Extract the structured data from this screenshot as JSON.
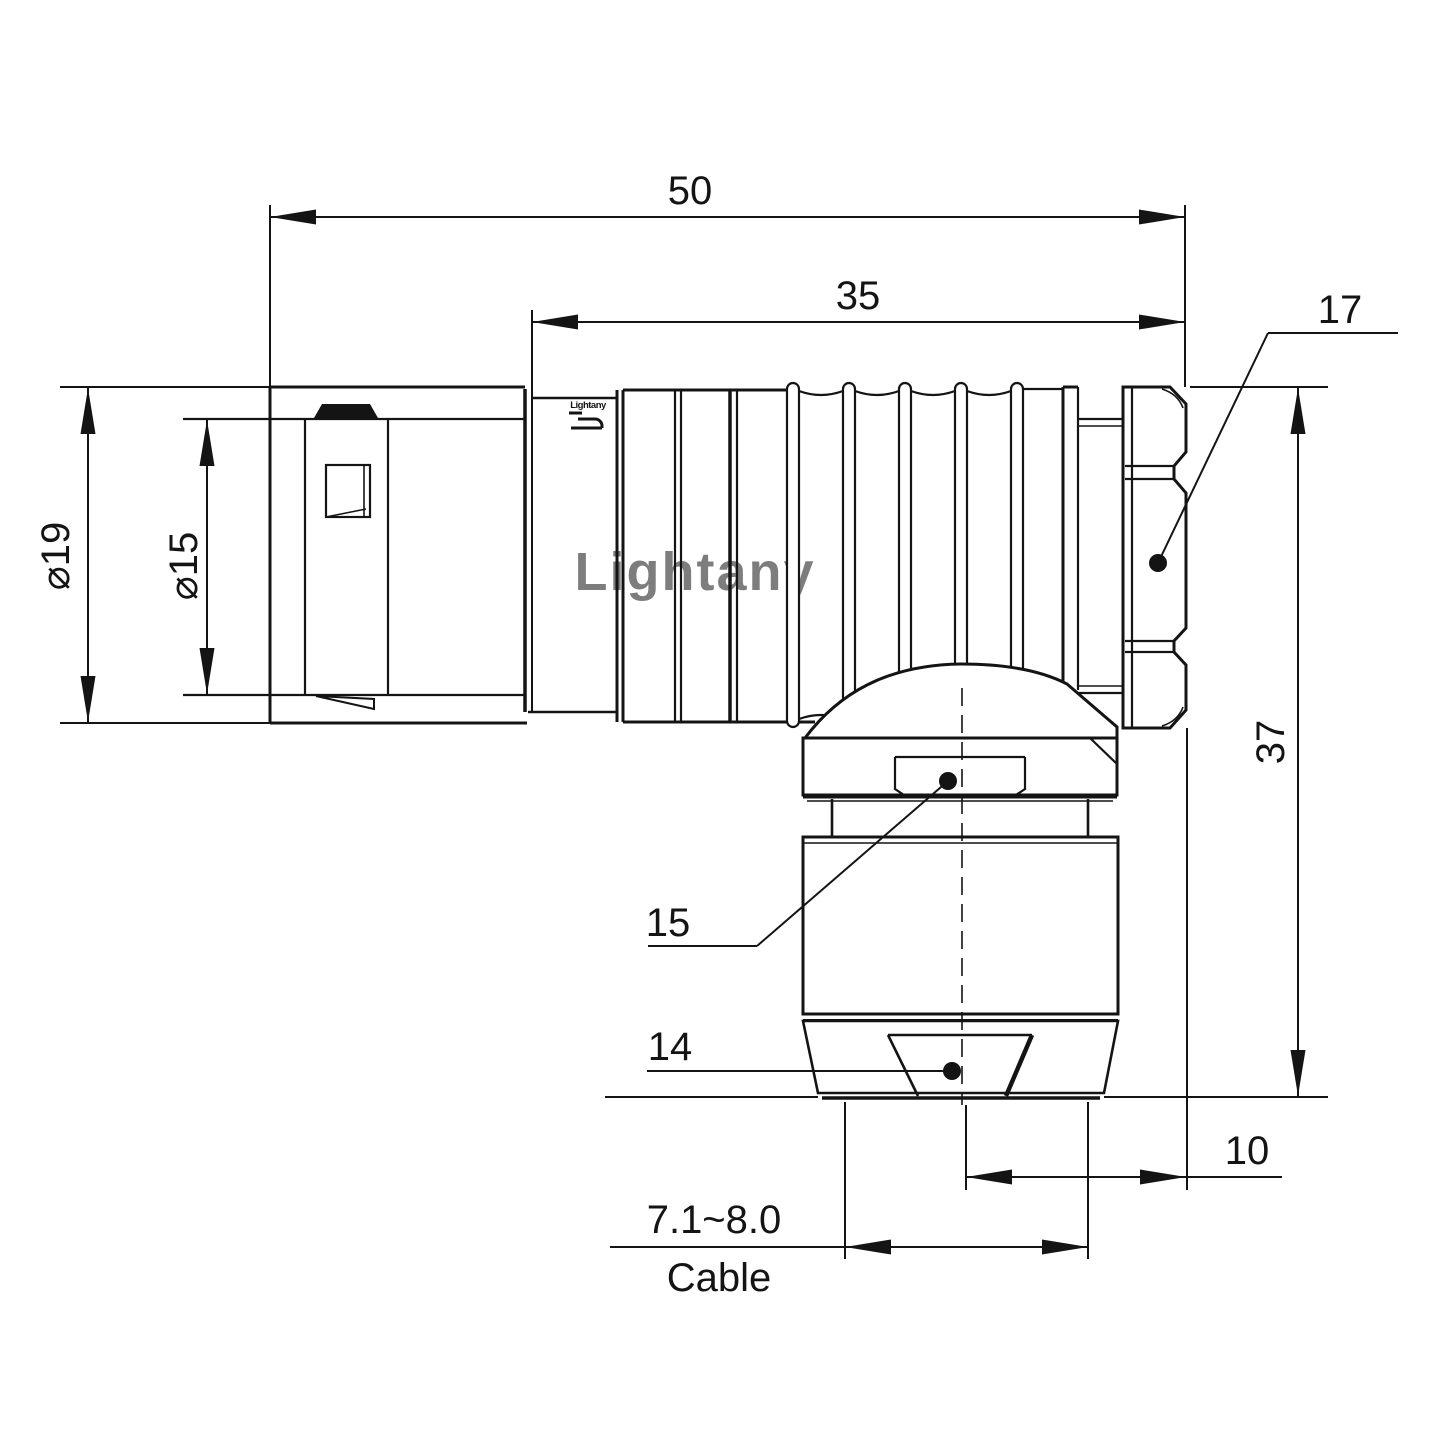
{
  "watermark": {
    "text": "Lightany",
    "color": "#f5baba"
  },
  "part_marking": "Lightany",
  "dims": {
    "overall_length": "50",
    "shell_length": "35",
    "hex_nut_width": "17",
    "outer_diameter": "⌀19",
    "inner_diameter": "⌀15",
    "total_height": "37",
    "gland_nut_width": "15",
    "collet_width": "14",
    "axis_to_face": "10",
    "cable_diameter_range": "7.1~8.0",
    "cable_caption": "Cable"
  }
}
